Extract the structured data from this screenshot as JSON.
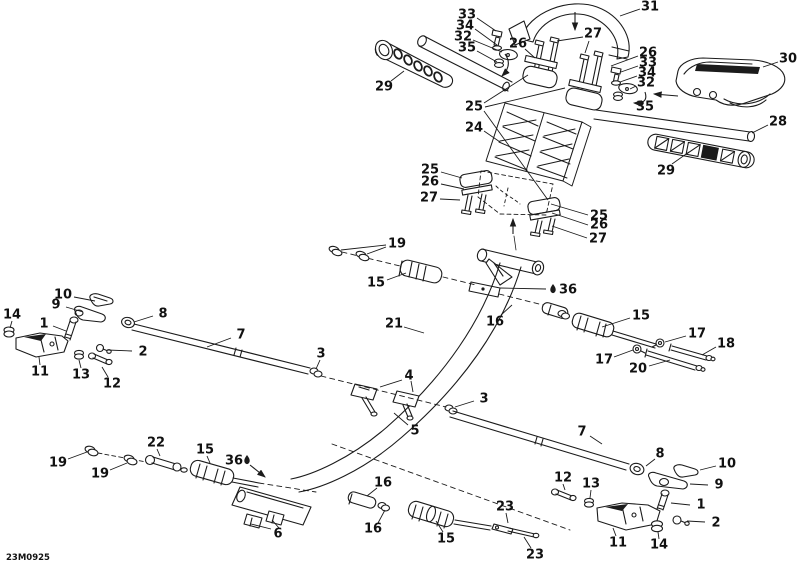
{
  "canvas": {
    "background": "#ffffff",
    "ink": "#1b1b1b",
    "label_color": "#111111"
  },
  "diagram": {
    "code": "23M0925",
    "callouts": [
      {
        "n": "33",
        "x": 467,
        "y": 15,
        "leaders": [
          [
            477,
            18,
            496,
            31
          ]
        ]
      },
      {
        "n": "34",
        "x": 465,
        "y": 26,
        "leaders": [
          [
            475,
            29,
            497,
            45
          ]
        ]
      },
      {
        "n": "32",
        "x": 463,
        "y": 37,
        "leaders": [
          [
            473,
            40,
            502,
            52
          ]
        ]
      },
      {
        "n": "35",
        "x": 467,
        "y": 48,
        "leaders": [
          [
            477,
            51,
            497,
            62
          ]
        ]
      },
      {
        "n": "29",
        "x": 384,
        "y": 87,
        "leaders": [
          [
            391,
            81,
            404,
            71
          ]
        ]
      },
      {
        "n": "26",
        "x": 518,
        "y": 44,
        "leaders": [
          [
            525,
            49,
            535,
            58
          ]
        ]
      },
      {
        "n": "27",
        "x": 593,
        "y": 34,
        "leaders": [
          [
            583,
            37,
            557,
            41
          ],
          [
            589,
            41,
            585,
            53
          ]
        ]
      },
      {
        "n": "31",
        "x": 650,
        "y": 7,
        "leaders": [
          [
            640,
            9,
            620,
            16
          ]
        ]
      },
      {
        "n": "26",
        "x": 648,
        "y": 53,
        "leaders": [
          [
            638,
            56,
            611,
            66
          ]
        ]
      },
      {
        "n": "33",
        "x": 648,
        "y": 63,
        "leaders": [
          [
            638,
            66,
            621,
            72
          ]
        ]
      },
      {
        "n": "34",
        "x": 647,
        "y": 73,
        "leaders": [
          [
            637,
            76,
            620,
            82
          ]
        ]
      },
      {
        "n": "32",
        "x": 646,
        "y": 83,
        "leaders": [
          [
            636,
            86,
            630,
            89
          ]
        ]
      },
      {
        "n": "35",
        "x": 645,
        "y": 107,
        "leaders": []
      },
      {
        "n": "30",
        "x": 788,
        "y": 59,
        "leaders": [
          [
            778,
            62,
            763,
            67
          ]
        ]
      },
      {
        "n": "28",
        "x": 778,
        "y": 122,
        "leaders": [
          [
            768,
            125,
            752,
            133
          ]
        ]
      },
      {
        "n": "29",
        "x": 666,
        "y": 171,
        "leaders": [
          [
            672,
            164,
            689,
            152
          ]
        ]
      },
      {
        "n": "25",
        "x": 474,
        "y": 107,
        "leaders": [
          [
            484,
            103,
            528,
            75
          ],
          [
            485,
            107,
            565,
            88
          ],
          [
            484,
            111,
            548,
            200
          ]
        ]
      },
      {
        "n": "24",
        "x": 474,
        "y": 128,
        "leaders": [
          [
            484,
            131,
            500,
            142
          ]
        ]
      },
      {
        "n": "25",
        "x": 430,
        "y": 170,
        "leaders": [
          [
            441,
            172,
            462,
            178
          ]
        ]
      },
      {
        "n": "26",
        "x": 430,
        "y": 182,
        "leaders": [
          [
            441,
            184,
            464,
            189
          ]
        ]
      },
      {
        "n": "27",
        "x": 429,
        "y": 198,
        "leaders": [
          [
            440,
            199,
            460,
            200
          ]
        ]
      },
      {
        "n": "25",
        "x": 599,
        "y": 216,
        "leaders": [
          [
            588,
            215,
            551,
            204
          ]
        ]
      },
      {
        "n": "26",
        "x": 599,
        "y": 225,
        "leaders": [
          [
            588,
            225,
            552,
            213
          ]
        ]
      },
      {
        "n": "27",
        "x": 598,
        "y": 239,
        "leaders": [
          [
            587,
            238,
            552,
            226
          ]
        ]
      },
      {
        "n": "19",
        "x": 397,
        "y": 244,
        "leaders": [
          [
            386,
            245,
            341,
            250
          ],
          [
            386,
            247,
            367,
            254
          ]
        ]
      },
      {
        "n": "15",
        "x": 376,
        "y": 283,
        "leaders": [
          [
            387,
            280,
            406,
            273
          ]
        ]
      },
      {
        "n": "36",
        "x": 568,
        "y": 290,
        "icon": "grease-drop-icon",
        "icon_x": 553,
        "icon_y": 289,
        "leaders": [
          [
            546,
            289,
            500,
            288
          ]
        ]
      },
      {
        "n": "21",
        "x": 394,
        "y": 324,
        "leaders": [
          [
            404,
            327,
            424,
            333
          ]
        ]
      },
      {
        "n": "16",
        "x": 495,
        "y": 322,
        "leaders": [
          [
            501,
            315,
            512,
            305
          ]
        ]
      },
      {
        "n": "15",
        "x": 641,
        "y": 316,
        "leaders": [
          [
            630,
            318,
            602,
            327
          ]
        ]
      },
      {
        "n": "17",
        "x": 697,
        "y": 334,
        "leaders": [
          [
            686,
            336,
            665,
            342
          ]
        ]
      },
      {
        "n": "18",
        "x": 726,
        "y": 344,
        "leaders": [
          [
            716,
            347,
            702,
            355
          ]
        ]
      },
      {
        "n": "17",
        "x": 604,
        "y": 360,
        "leaders": [
          [
            614,
            357,
            633,
            350
          ]
        ]
      },
      {
        "n": "20",
        "x": 638,
        "y": 369,
        "leaders": [
          [
            649,
            366,
            670,
            360
          ]
        ]
      },
      {
        "n": "3",
        "x": 321,
        "y": 354,
        "leaders": [
          [
            320,
            360,
            316,
            369
          ]
        ]
      },
      {
        "n": "4",
        "x": 409,
        "y": 376,
        "leaders": [
          [
            402,
            380,
            380,
            387
          ],
          [
            411,
            381,
            413,
            392
          ]
        ]
      },
      {
        "n": "3",
        "x": 484,
        "y": 399,
        "leaders": [
          [
            474,
            401,
            455,
            407
          ]
        ]
      },
      {
        "n": "5",
        "x": 415,
        "y": 431,
        "leaders": [
          [
            408,
            425,
            394,
            413
          ]
        ]
      },
      {
        "n": "7",
        "x": 241,
        "y": 335,
        "leaders": [
          [
            231,
            338,
            207,
            347
          ]
        ]
      },
      {
        "n": "8",
        "x": 163,
        "y": 314,
        "leaders": [
          [
            153,
            316,
            134,
            322
          ]
        ]
      },
      {
        "n": "10",
        "x": 63,
        "y": 295,
        "leaders": [
          [
            74,
            297,
            95,
            301
          ]
        ]
      },
      {
        "n": "9",
        "x": 56,
        "y": 305,
        "leaders": [
          [
            66,
            307,
            83,
            312
          ]
        ]
      },
      {
        "n": "14",
        "x": 12,
        "y": 315,
        "leaders": [
          [
            12,
            321,
            10,
            328
          ]
        ]
      },
      {
        "n": "1",
        "x": 44,
        "y": 324,
        "leaders": [
          [
            53,
            326,
            66,
            331
          ]
        ]
      },
      {
        "n": "2",
        "x": 143,
        "y": 352,
        "leaders": [
          [
            132,
            351,
            107,
            350
          ]
        ]
      },
      {
        "n": "11",
        "x": 40,
        "y": 372,
        "leaders": [
          [
            40,
            365,
            39,
            357
          ]
        ]
      },
      {
        "n": "13",
        "x": 81,
        "y": 375,
        "leaders": [
          [
            81,
            368,
            79,
            360
          ]
        ]
      },
      {
        "n": "12",
        "x": 112,
        "y": 384,
        "leaders": [
          [
            108,
            377,
            102,
            367
          ]
        ]
      },
      {
        "n": "19",
        "x": 58,
        "y": 463,
        "leaders": [
          [
            68,
            459,
            87,
            452
          ]
        ]
      },
      {
        "n": "19",
        "x": 100,
        "y": 474,
        "leaders": [
          [
            110,
            470,
            127,
            463
          ]
        ]
      },
      {
        "n": "22",
        "x": 156,
        "y": 443,
        "leaders": [
          [
            157,
            449,
            160,
            456
          ]
        ]
      },
      {
        "n": "15",
        "x": 205,
        "y": 450,
        "leaders": [
          [
            207,
            456,
            210,
            463
          ]
        ]
      },
      {
        "n": "36",
        "x": 234,
        "y": 461,
        "icon": "grease-drop-icon",
        "icon_x": 247,
        "icon_y": 460,
        "leaders": []
      },
      {
        "n": "6",
        "x": 278,
        "y": 534,
        "leaders": [
          [
            271,
            529,
            251,
            524
          ],
          [
            279,
            528,
            272,
            520
          ]
        ]
      },
      {
        "n": "16",
        "x": 383,
        "y": 483,
        "leaders": [
          [
            377,
            488,
            367,
            496
          ]
        ]
      },
      {
        "n": "16",
        "x": 373,
        "y": 529,
        "leaders": [
          [
            378,
            523,
            385,
            510
          ]
        ]
      },
      {
        "n": "15",
        "x": 446,
        "y": 539,
        "leaders": [
          [
            443,
            532,
            436,
            521
          ]
        ]
      },
      {
        "n": "23",
        "x": 505,
        "y": 507,
        "leaders": [
          [
            506,
            513,
            508,
            523
          ]
        ]
      },
      {
        "n": "23",
        "x": 535,
        "y": 555,
        "leaders": [
          [
            531,
            548,
            524,
            537
          ]
        ]
      },
      {
        "n": "12",
        "x": 563,
        "y": 478,
        "leaders": [
          [
            563,
            484,
            565,
            490
          ]
        ]
      },
      {
        "n": "13",
        "x": 591,
        "y": 484,
        "leaders": [
          [
            591,
            490,
            590,
            498
          ]
        ]
      },
      {
        "n": "7",
        "x": 582,
        "y": 432,
        "leaders": [
          [
            590,
            436,
            602,
            444
          ]
        ]
      },
      {
        "n": "8",
        "x": 660,
        "y": 454,
        "leaders": [
          [
            655,
            459,
            646,
            466
          ]
        ]
      },
      {
        "n": "10",
        "x": 727,
        "y": 464,
        "leaders": [
          [
            716,
            466,
            700,
            470
          ]
        ]
      },
      {
        "n": "9",
        "x": 719,
        "y": 485,
        "leaders": [
          [
            708,
            485,
            690,
            484
          ]
        ]
      },
      {
        "n": "1",
        "x": 701,
        "y": 505,
        "leaders": [
          [
            690,
            505,
            671,
            503
          ]
        ]
      },
      {
        "n": "2",
        "x": 716,
        "y": 523,
        "leaders": [
          [
            705,
            522,
            687,
            521
          ]
        ]
      },
      {
        "n": "11",
        "x": 618,
        "y": 543,
        "leaders": [
          [
            616,
            536,
            613,
            528
          ]
        ]
      },
      {
        "n": "14",
        "x": 659,
        "y": 545,
        "leaders": [
          [
            659,
            539,
            658,
            532
          ]
        ]
      }
    ],
    "arrows": [
      {
        "name": "insert-direction-arrow",
        "d": "M575,12 L575,30"
      },
      {
        "name": "insert-direction-arrow",
        "d": "M513,234 L513,219"
      },
      {
        "name": "insert-direction-arrow",
        "d": "M678,96 L654,94"
      },
      {
        "name": "grease-point-arrow",
        "d": "M250,465 L265,477"
      },
      {
        "name": "rotate-direction-arrow",
        "d": "M505,54 Q513,65 502,76"
      },
      {
        "name": "rotate-direction-arrow",
        "d": "M645,92 Q649,104 634,103"
      }
    ]
  }
}
